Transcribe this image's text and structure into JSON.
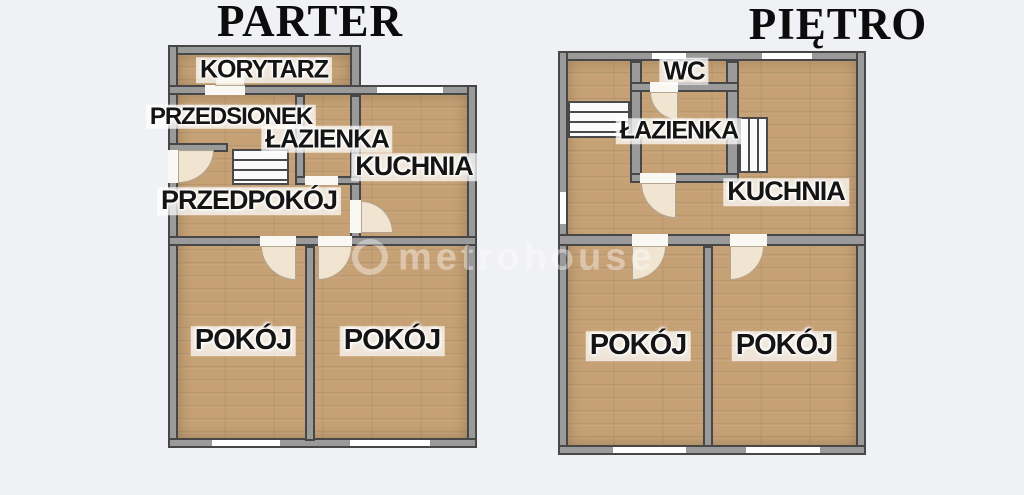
{
  "parter": {
    "title": "PARTER",
    "rooms": {
      "korytarz": "KORYTARZ",
      "przedsionek": "PRZEDSIONEK",
      "lazienka": "ŁAZIENKA",
      "kuchnia": "KUCHNIA",
      "przedpokoj": "PRZEDPOKÓJ",
      "pokoj_lewy": "POKÓJ",
      "pokoj_prawy": "POKÓJ"
    }
  },
  "pietro": {
    "title": "PIĘTRO",
    "rooms": {
      "wc": "WC",
      "lazienka": "ŁAZIENKA",
      "kuchnia": "KUCHNIA",
      "pokoj_lewy": "POKÓJ",
      "pokoj_prawy": "POKÓJ"
    }
  },
  "watermark": {
    "text": "metrohouse"
  },
  "colors": {
    "background": "#f0f1f5",
    "wall_fill": "#9a9a9a",
    "wall_outline": "#474747",
    "floor_wood": "#c6a175",
    "door_swing": "#f3e9d7",
    "opening_white": "#faf8f3",
    "label_text": "#141414",
    "label_halo": "#ffffff",
    "title_text": "#0c0c0c"
  }
}
